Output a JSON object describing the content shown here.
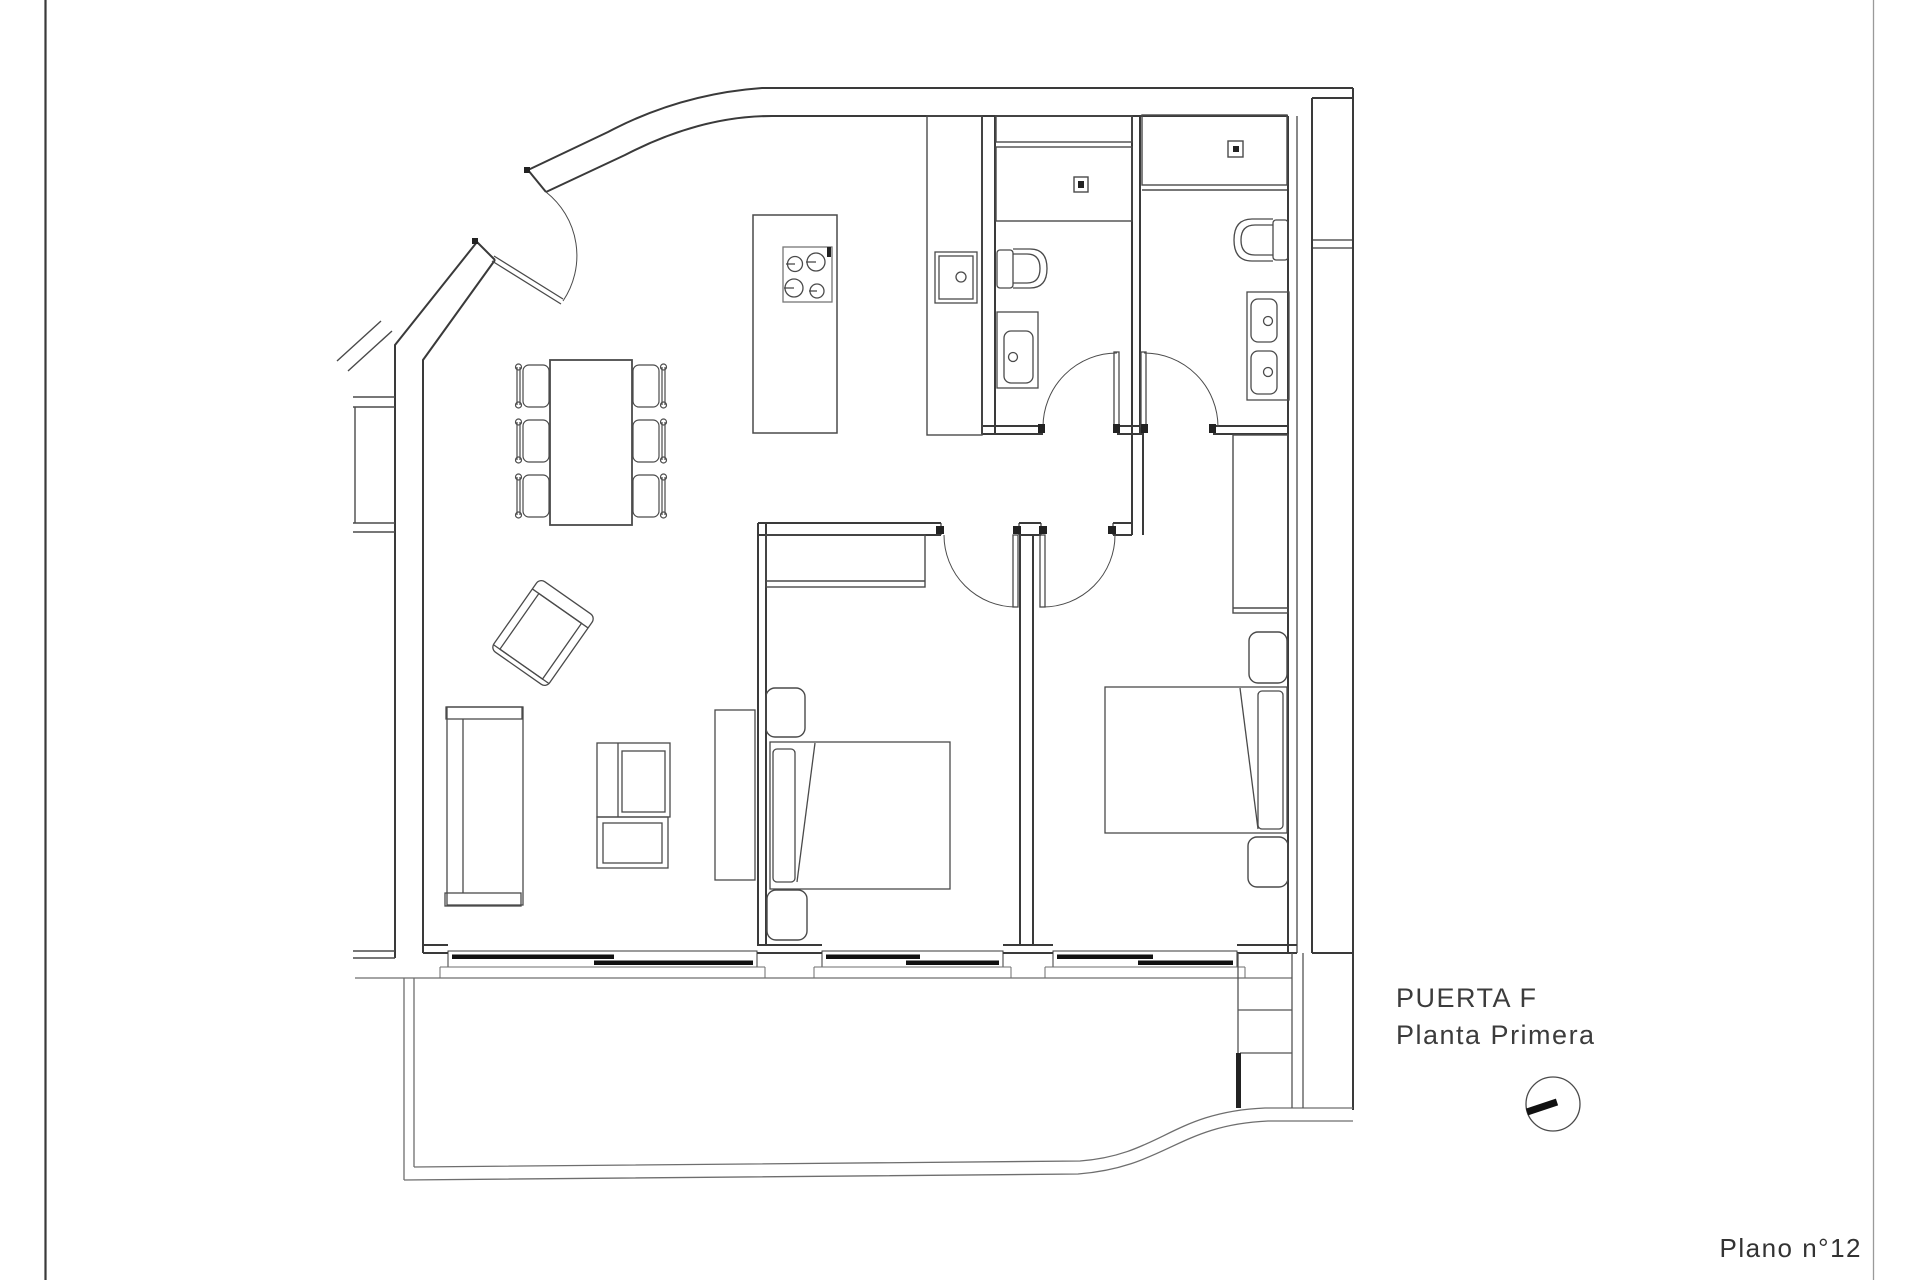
{
  "title": {
    "line1": "PUERTA F",
    "line2": "Planta Primera"
  },
  "sheet": {
    "number_label": "Plano n°12"
  },
  "colors": {
    "background": "#ffffff",
    "wall_line": "#3a3a3a",
    "furniture_line": "#4a4a4a",
    "light_line": "#6e6e6e",
    "text": "#3c3c3c",
    "window_fill": "#111111"
  },
  "icons": {
    "north_indicator": "circle-with-thick-bar"
  }
}
